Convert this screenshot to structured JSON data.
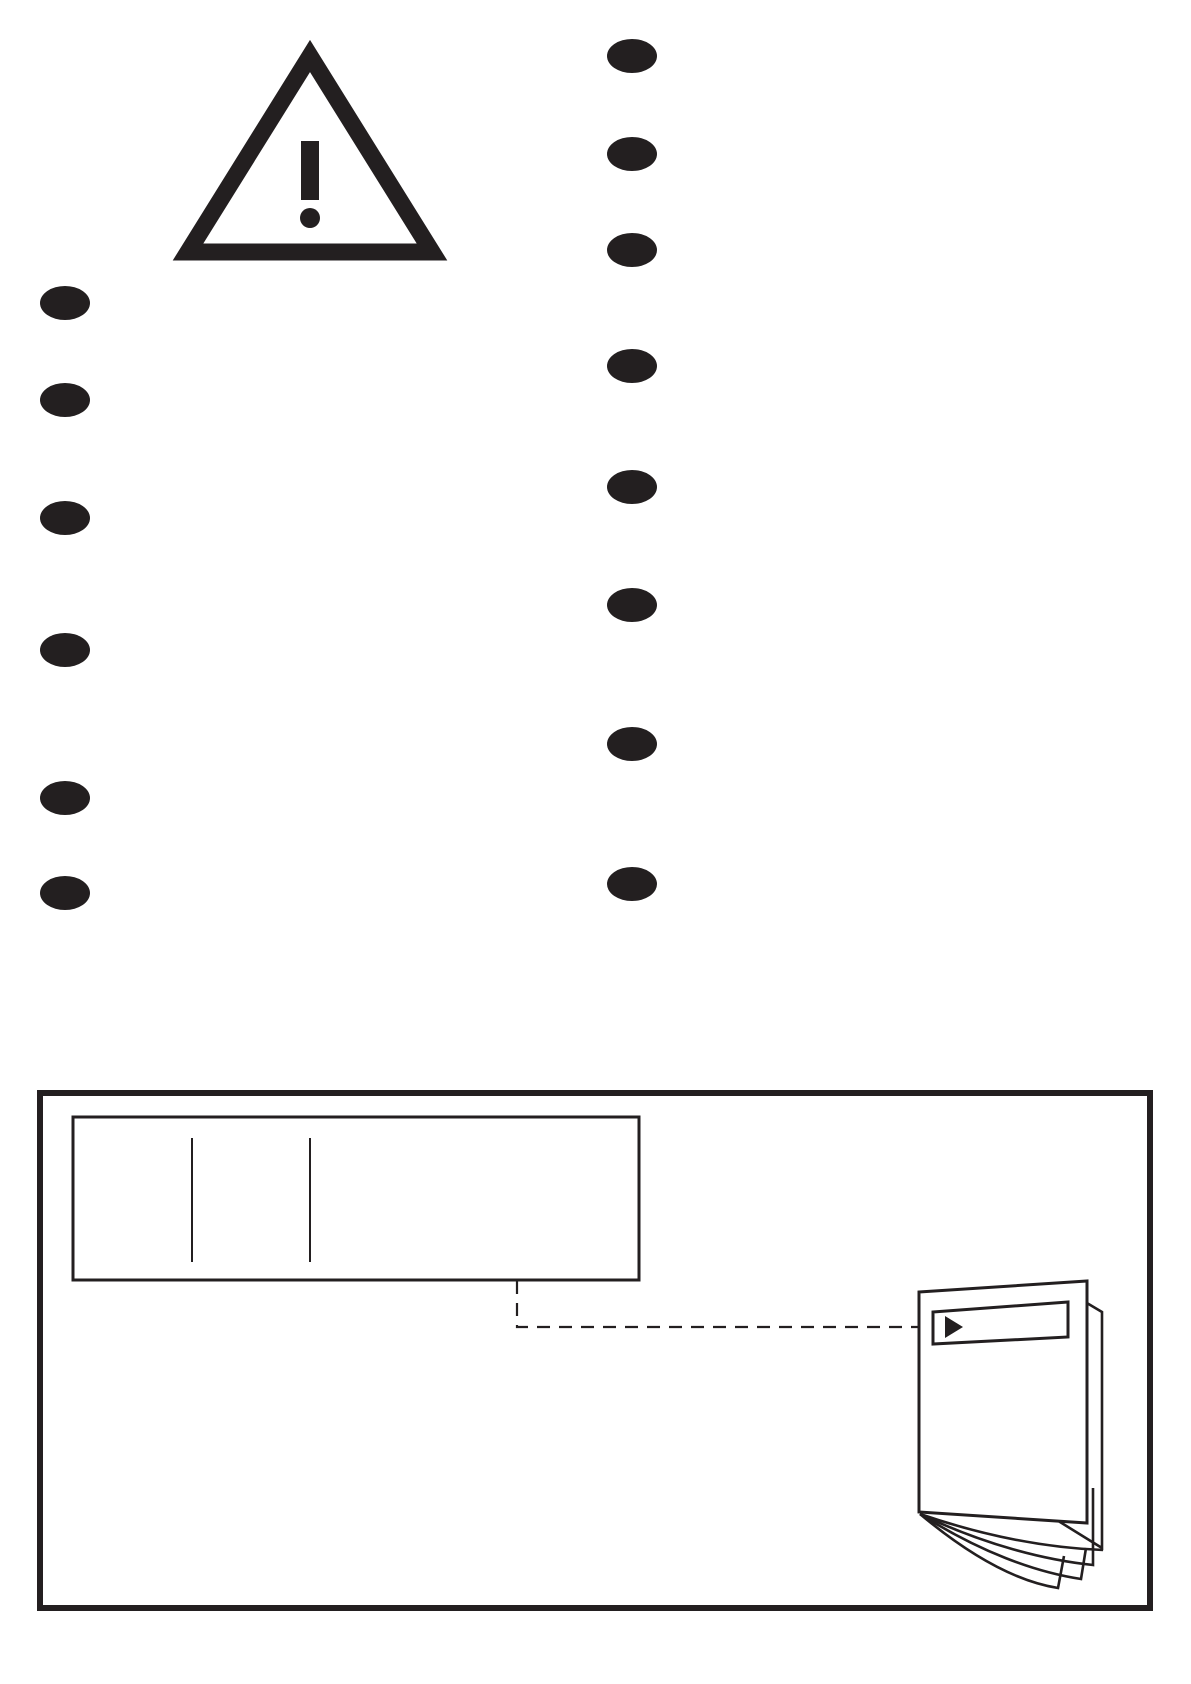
{
  "page": {
    "kind": "instruction-manual-safety-page",
    "width": 1191,
    "height": 1684,
    "background": "#ffffff",
    "ink": "#231f20"
  },
  "warning": {
    "icon": "warning-triangle-icon",
    "symbol": "!"
  },
  "bullet_lists": {
    "marker_icon": "bullet-marker",
    "marker": {
      "rx": 25,
      "ry": 17
    },
    "columns": [
      {
        "name": "left",
        "x": 65,
        "ys": [
          303,
          400,
          518,
          650,
          798,
          893
        ]
      },
      {
        "name": "right",
        "x": 632,
        "ys": [
          56,
          154,
          250,
          366,
          487,
          605,
          744,
          884
        ]
      }
    ]
  },
  "bottom_panel": {
    "label_box": {
      "separator_xs": [
        192,
        310
      ]
    },
    "leader": {
      "style": "dashed"
    },
    "booklet": {
      "icon": "booklet-icon",
      "arrow_icon": "arrow-right-icon",
      "fanned_pages": 4
    }
  }
}
